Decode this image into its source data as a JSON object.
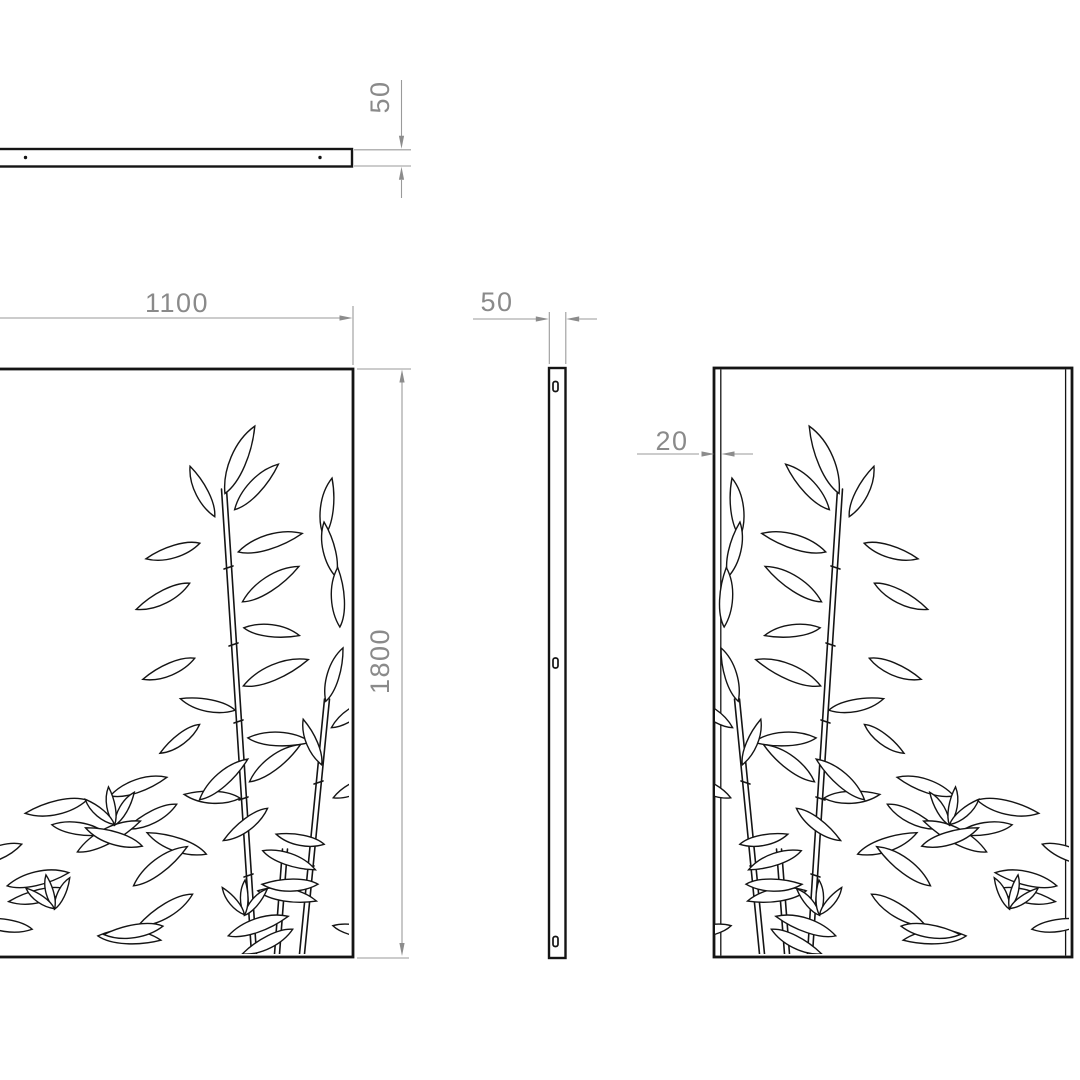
{
  "colors": {
    "background": "#ffffff",
    "outline": "#141414",
    "dimension_line": "#9a9a9a",
    "dimension_text": "#8a8a8a"
  },
  "views": {
    "top_view": {
      "hole_count": 2
    },
    "side_view": {
      "slot_count": 3
    }
  },
  "dimensions": {
    "top_thickness": "50",
    "panel_width": "1100",
    "panel_height": "1800",
    "side_thickness": "50",
    "flange_depth": "20"
  }
}
